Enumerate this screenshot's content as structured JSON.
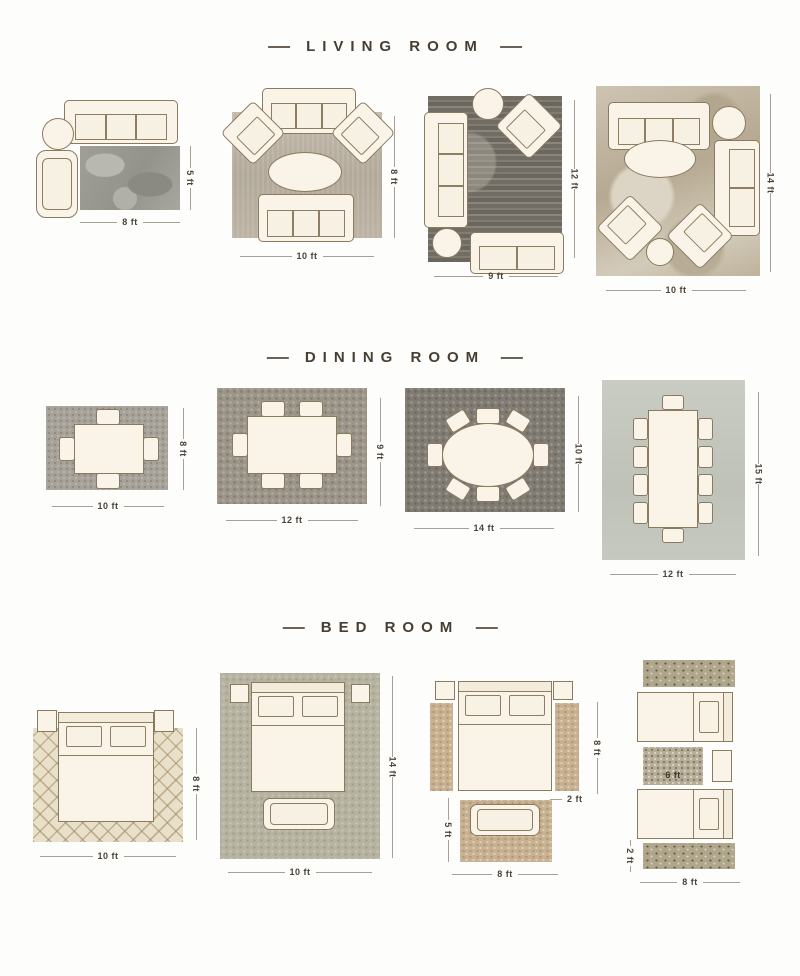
{
  "page": {
    "background": "#fdfdfb"
  },
  "sections": [
    {
      "title": "LIVING ROOM",
      "layouts": [
        {
          "width_label": "8 ft",
          "height_label": "5 ft"
        },
        {
          "width_label": "10 ft",
          "height_label": "8 ft"
        },
        {
          "width_label": "9 ft",
          "height_label": "12 ft"
        },
        {
          "width_label": "10 ft",
          "height_label": "14 ft"
        }
      ]
    },
    {
      "title": "DINING ROOM",
      "layouts": [
        {
          "width_label": "10 ft",
          "height_label": "8 ft"
        },
        {
          "width_label": "12 ft",
          "height_label": "9 ft"
        },
        {
          "width_label": "14 ft",
          "height_label": "10 ft"
        },
        {
          "width_label": "12 ft",
          "height_label": "15 ft"
        }
      ]
    },
    {
      "title": "BED ROOM",
      "layouts": [
        {
          "width_label": "10 ft",
          "height_label": "8 ft"
        },
        {
          "width_label": "10 ft",
          "height_label": "14 ft"
        },
        {
          "width_label": "8 ft",
          "height_label": "8 ft",
          "runner_label": "2 ft",
          "bench_rug_height_label": "5 ft"
        },
        {
          "width_label": "8 ft",
          "runner_width_label": "6 ft",
          "runner_height_label": "2 ft"
        }
      ]
    }
  ],
  "colors": {
    "title_text": "#46423a",
    "dimension_text": "#4a4238",
    "furniture_fill": "#f9f4e7",
    "furniture_outline": "#8a7a60"
  }
}
